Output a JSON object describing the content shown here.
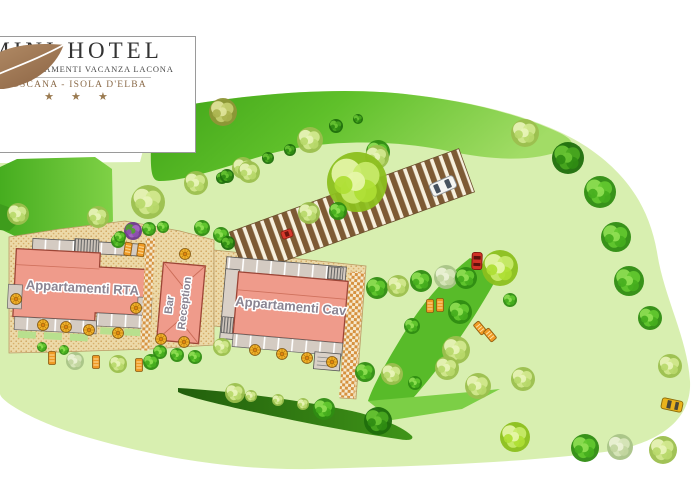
{
  "logo": {
    "title": "MINI HOTEL",
    "subtitle": "RTA & APPARTAMENTI VACANZA LACONA",
    "location": "TOSCANA - ISOLA D'ELBA",
    "stars": "★ ★ ★"
  },
  "map": {
    "labels": {
      "rta": "Appartamenti RTA",
      "bar": "Bar",
      "reception": "Reception",
      "cav": "Appartamenti Cav"
    },
    "colors": {
      "lawn": "#d8efb0",
      "band": "#4fb422",
      "hedge": "#2e7d12",
      "sand": "#ecd9a8",
      "sanddot": "#cfa45f",
      "checker": "#d6913f",
      "building": "#ef9b8b",
      "outline": "#9c4536",
      "label": "#8a8492",
      "grayunit": "#d4cbc2",
      "stripebrown": "#7d5a34",
      "stripecream": "#f6efdd",
      "parasol": "#f2b32b",
      "lounger": "#ef9a25"
    },
    "trees": [
      [
        223,
        112,
        14,
        "olive"
      ],
      [
        310,
        140,
        13,
        "pale"
      ],
      [
        336,
        126,
        7,
        "dark"
      ],
      [
        290,
        150,
        6,
        "dark"
      ],
      [
        268,
        158,
        6,
        "dark"
      ],
      [
        243,
        168,
        11,
        "pale"
      ],
      [
        196,
        183,
        12,
        "pale"
      ],
      [
        222,
        178,
        6,
        "dark"
      ],
      [
        358,
        119,
        5,
        "dark"
      ],
      [
        378,
        152,
        12,
        "bright"
      ],
      [
        525,
        133,
        14,
        "pale"
      ],
      [
        568,
        158,
        16,
        "dark"
      ],
      [
        600,
        192,
        16,
        "bright"
      ],
      [
        616,
        237,
        15,
        "bright"
      ],
      [
        629,
        281,
        15,
        "bright"
      ],
      [
        650,
        318,
        12,
        "bright"
      ],
      [
        249,
        172,
        11,
        "pale"
      ],
      [
        227,
        176,
        7,
        "dark"
      ],
      [
        377,
        157,
        12,
        "pale"
      ],
      [
        357,
        182,
        30,
        "lime"
      ],
      [
        148,
        202,
        17,
        "pale"
      ],
      [
        309,
        213,
        11,
        "pale"
      ],
      [
        338,
        211,
        9,
        "bright"
      ],
      [
        18,
        214,
        11,
        "pale"
      ],
      [
        98,
        217,
        11,
        "pale"
      ],
      [
        118,
        241,
        7,
        "bright"
      ],
      [
        133,
        231,
        9,
        "purple"
      ],
      [
        120,
        237,
        6,
        "bright"
      ],
      [
        149,
        229,
        7,
        "bright"
      ],
      [
        163,
        227,
        6,
        "bright"
      ],
      [
        202,
        228,
        8,
        "bright"
      ],
      [
        221,
        235,
        8,
        "bright"
      ],
      [
        228,
        243,
        7,
        "dark"
      ],
      [
        377,
        288,
        11,
        "bright"
      ],
      [
        398,
        286,
        11,
        "pale"
      ],
      [
        421,
        281,
        11,
        "bright"
      ],
      [
        446,
        277,
        12,
        "drab"
      ],
      [
        466,
        278,
        11,
        "bright"
      ],
      [
        500,
        268,
        18,
        "lime"
      ],
      [
        510,
        300,
        7,
        "bright"
      ],
      [
        460,
        312,
        12,
        "bright"
      ],
      [
        456,
        350,
        14,
        "pale"
      ],
      [
        412,
        326,
        8,
        "bright"
      ],
      [
        365,
        372,
        10,
        "bright"
      ],
      [
        392,
        374,
        11,
        "pale"
      ],
      [
        415,
        383,
        7,
        "bright"
      ],
      [
        160,
        352,
        7,
        "bright"
      ],
      [
        177,
        355,
        7,
        "bright"
      ],
      [
        195,
        357,
        7,
        "bright"
      ],
      [
        222,
        347,
        9,
        "pale"
      ],
      [
        42,
        347,
        5,
        "bright"
      ],
      [
        64,
        350,
        5,
        "bright"
      ],
      [
        75,
        361,
        9,
        "drab"
      ],
      [
        118,
        364,
        9,
        "pale"
      ],
      [
        151,
        362,
        8,
        "bright"
      ],
      [
        235,
        393,
        10,
        "pale"
      ],
      [
        251,
        396,
        6,
        "pale"
      ],
      [
        278,
        400,
        6,
        "pale"
      ],
      [
        303,
        404,
        6,
        "pale"
      ],
      [
        324,
        409,
        11,
        "bright"
      ],
      [
        378,
        421,
        14,
        "dark"
      ],
      [
        447,
        368,
        12,
        "pale"
      ],
      [
        478,
        386,
        13,
        "pale"
      ],
      [
        523,
        379,
        12,
        "pale"
      ],
      [
        515,
        437,
        15,
        "lime"
      ],
      [
        585,
        448,
        14,
        "bright"
      ],
      [
        620,
        447,
        13,
        "drab"
      ],
      [
        663,
        450,
        14,
        "pale"
      ],
      [
        670,
        366,
        12,
        "pale"
      ]
    ],
    "parasols": [
      [
        185,
        254
      ],
      [
        16,
        299
      ],
      [
        136,
        308
      ],
      [
        43,
        325
      ],
      [
        66,
        327
      ],
      [
        89,
        330
      ],
      [
        118,
        333
      ],
      [
        161,
        339
      ],
      [
        184,
        342
      ],
      [
        255,
        350
      ],
      [
        282,
        354
      ],
      [
        307,
        358
      ],
      [
        332,
        362
      ]
    ],
    "loungers": [
      [
        128,
        249,
        8
      ],
      [
        141,
        250,
        8
      ],
      [
        430,
        306,
        0
      ],
      [
        440,
        305,
        0
      ],
      [
        480,
        328,
        -40
      ],
      [
        490,
        335,
        -40
      ],
      [
        52,
        358,
        0
      ],
      [
        96,
        362,
        0
      ],
      [
        139,
        365,
        0
      ]
    ],
    "cars": [
      {
        "kind": "white",
        "x": 443,
        "y": 186,
        "rot": -24
      },
      {
        "kind": "red",
        "x": 477,
        "y": 261,
        "rot": 2
      },
      {
        "kind": "red-small",
        "x": 287,
        "y": 234,
        "rot": -20
      },
      {
        "kind": "yellow",
        "x": 672,
        "y": 405,
        "rot": 12
      }
    ]
  }
}
